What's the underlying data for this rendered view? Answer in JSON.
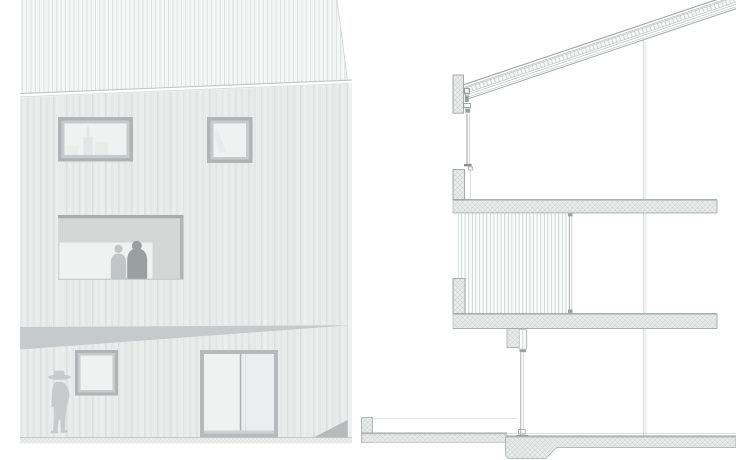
{
  "document": {
    "kind": "architectural drawing",
    "views": [
      {
        "id": "elevation",
        "label": "building elevation with timber cladding"
      },
      {
        "id": "section",
        "label": "building cross-section"
      }
    ],
    "text_content": []
  },
  "colors": {
    "background": "#ffffff",
    "wall_base": "#e9ebeb",
    "wall_streak_dark": "#dee0e0",
    "wall_streak_light": "#f0f2f2",
    "roof_base": "#f8f9f9",
    "roof_stripe": "#dcdede",
    "frame_outer": "#b1b4b4",
    "frame_inner": "#c8cbcb",
    "frame_dark": "#a9abab",
    "glass": "#f0f2f2",
    "glass_dim": "#ebedee",
    "soffit": "#d5d7d7",
    "reflection": "#e3e6e6",
    "figure_light": "#c2c6c6",
    "figure_dark": "#9aa0a0",
    "person_outdoor": "#c7cbcb",
    "shadow_wedge": "#c7caca",
    "shadow_corner": "#b6baba",
    "hatch_base": "#eaecec",
    "hatch_line": "#d2d4d4",
    "slat_base": "#fbfcfc",
    "slat_line": "#c9cccc",
    "ladder_base": "#f4f5f5",
    "ladder_tick": "#c2c4c4",
    "ground_base": "#eceeee",
    "ground_hatch": "#dadcdc",
    "line_strong": "#9fa2a2",
    "line_mid": "#b4b7b7",
    "line_light": "#ccd0d0",
    "detail_dark": "#8b8e8e"
  }
}
